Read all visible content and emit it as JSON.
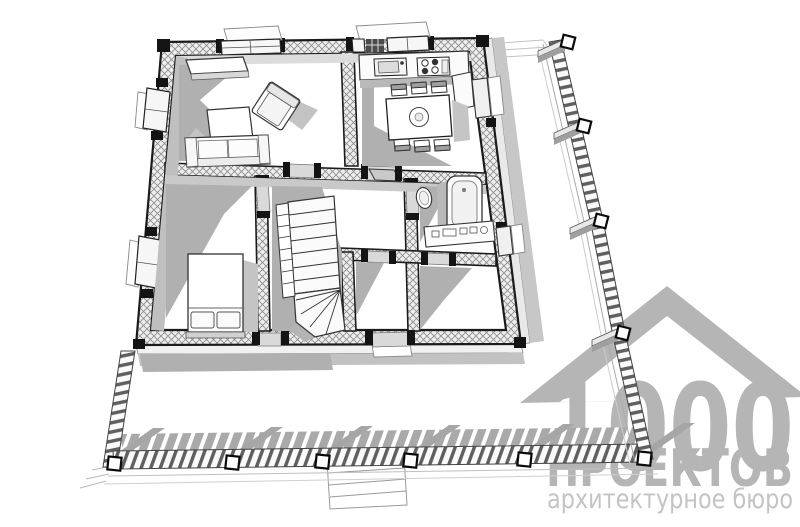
{
  "watermark": {
    "logo_number": "1000",
    "studio_name": "ПРОЕКТОВ",
    "tagline": "архитектурное бюро",
    "logo_color": "#b5b5b5",
    "tagline_color": "#c4c4c4"
  },
  "drawing": {
    "type": "axonometric-cutaway-floor-plan",
    "background_color": "#ffffff",
    "outline_color": "#1b1b1b",
    "wall_fill_color": "#ededed",
    "hatch_line_color": "#8f8f8f",
    "shadow_color": "#acacac",
    "rooms": [
      "living-room",
      "kitchen",
      "bedroom",
      "stair-hall",
      "bathroom",
      "storage-room",
      "entrance-hall",
      "terrace"
    ],
    "fixtures": {
      "living_room": [
        "sofa",
        "armchair",
        "coffee-table",
        "tv-console",
        "windows"
      ],
      "kitchen": [
        "worktop",
        "sink",
        "cooktop",
        "dining-table",
        "six-chairs"
      ],
      "bedroom": [
        "double-bed",
        "pillows"
      ],
      "bathroom": [
        "bathtub",
        "washbasin",
        "vanity-counter"
      ],
      "stair_hall": [
        "winder-staircase",
        "stair-railing"
      ],
      "terrace": [
        "balustrade",
        "corner-posts",
        "entry-steps"
      ]
    }
  }
}
